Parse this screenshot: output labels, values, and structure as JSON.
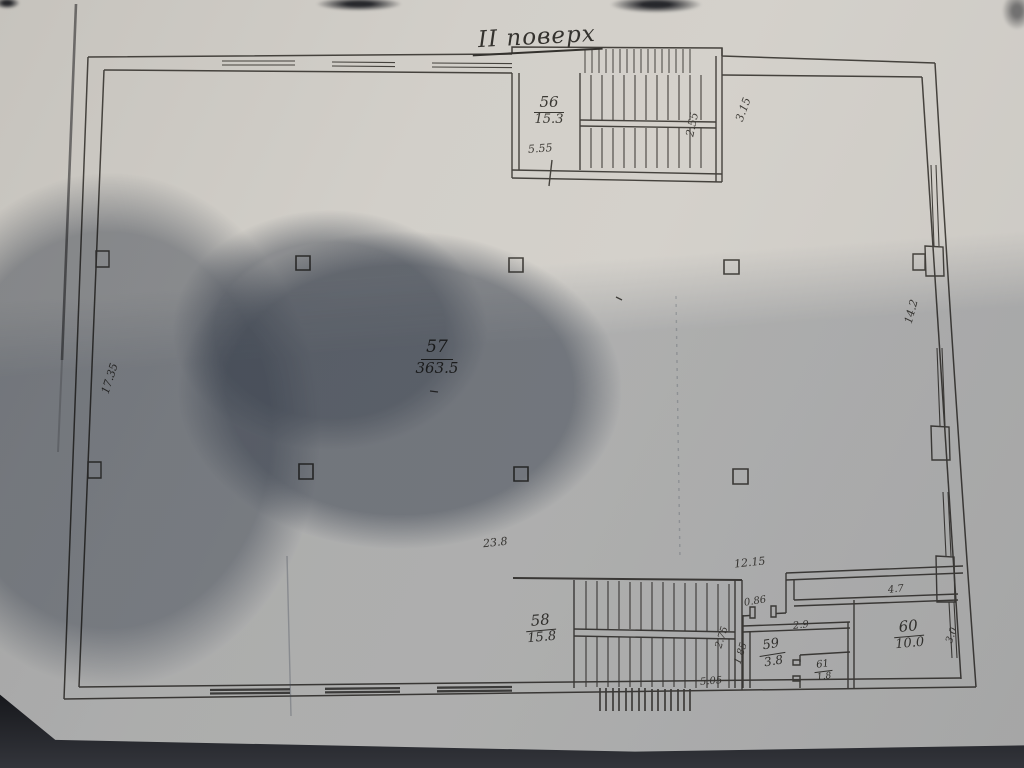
{
  "document": {
    "title": "II поверх",
    "rooms": [
      {
        "number": "56",
        "area": "15.3"
      },
      {
        "number": "57",
        "area": "363.5"
      },
      {
        "number": "58",
        "area": "15.8"
      },
      {
        "number": "59",
        "area": "3.8"
      },
      {
        "number": "60",
        "area": "10.0"
      },
      {
        "number": "61",
        "area": "1.8"
      }
    ],
    "dimensions": {
      "stair_top_width": "5.55",
      "stair_top_depth": "2.55",
      "wall_top_right": "3.15",
      "wall_left": "17.35",
      "wall_right": "14.2",
      "hall_bottom": "23.8",
      "corridor": "12.15",
      "door": "0.86",
      "room59_width": "2.9",
      "room59_left": "1.85",
      "stair_bottom_depth": "2.75",
      "stair_bottom_width": "5.05",
      "room60_width": "4.7",
      "room60_depth": "3.0"
    },
    "colors": {
      "paper": "#d2cfc9",
      "ink": "#45423d",
      "shadow": "#687488",
      "background": "#1a1b1f"
    }
  }
}
